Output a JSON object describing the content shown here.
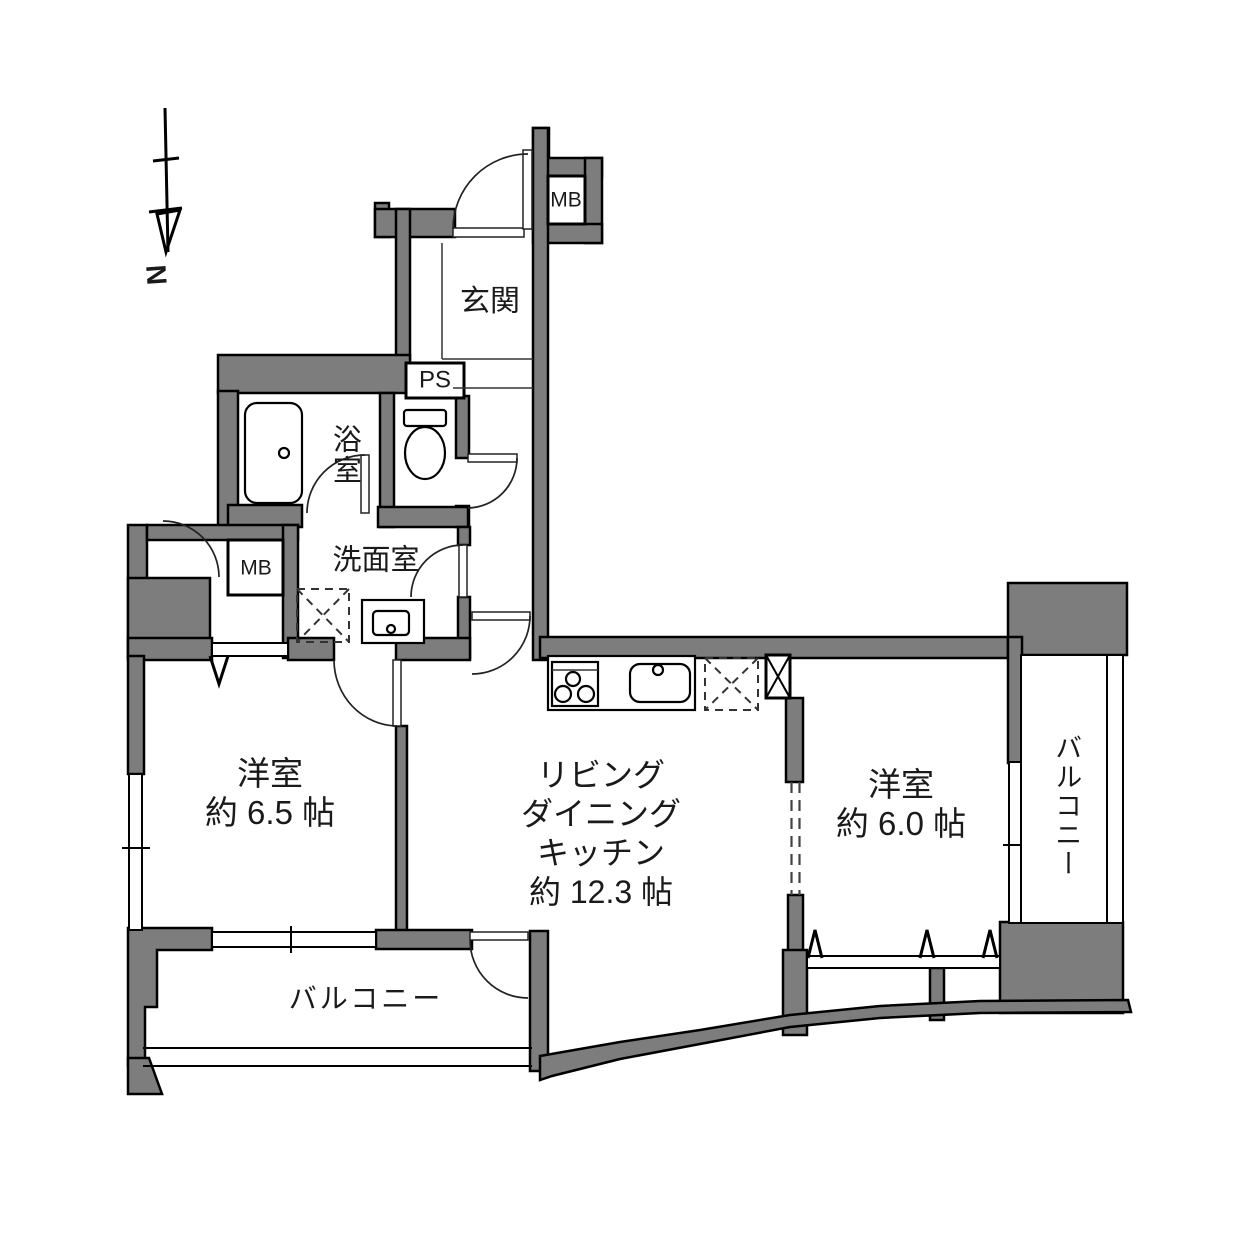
{
  "floor_plan": {
    "compass": "N",
    "entrance": "玄関",
    "pipe_space": "PS",
    "meter_box_top": "MB",
    "meter_box_left": "MB",
    "bathroom": "浴室",
    "washroom": "洗面室",
    "bedroom_left": {
      "name": "洋室",
      "size": "約 6.5 帖"
    },
    "ldk": {
      "line1": "リビング",
      "line2": "ダイニング",
      "line3": "キッチン",
      "size": "約 12.3 帖"
    },
    "bedroom_right": {
      "name": "洋室",
      "size": "約 6.0 帖"
    },
    "balcony_south": "バルコニー",
    "balcony_east": "バルコニー",
    "colors": {
      "wall_fill": "#7d7d7d",
      "outline": "#000000",
      "background": "#ffffff"
    }
  }
}
